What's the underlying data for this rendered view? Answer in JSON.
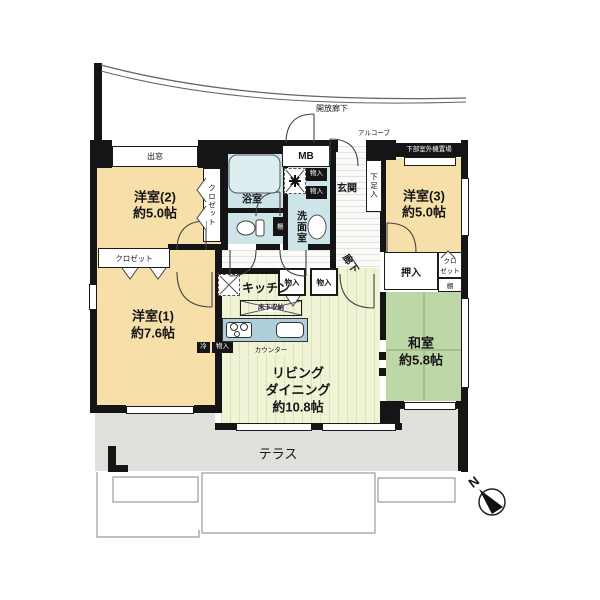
{
  "plan": {
    "compass_n": "N",
    "open_corridor": "開放廊下",
    "alcove": "アルコーブ",
    "outdoor_unit_area": "下部室外機置場",
    "bay_window": "出窓",
    "meter_box": "MB",
    "terrace": "テラス",
    "rooms": {
      "western2_name": "洋室(2)",
      "western2_size": "約5.0帖",
      "western3_name": "洋室(3)",
      "western3_size": "約5.0帖",
      "western1_name": "洋室(1)",
      "western1_size": "約7.6帖",
      "japanese_name": "和室",
      "japanese_size": "約5.8帖",
      "living_line1": "リビング",
      "living_line2": "ダイニング",
      "living_size": "約10.8帖",
      "kitchen": "キッチン",
      "bathroom": "浴室",
      "washroom": "洗面室",
      "entrance": "玄関",
      "hallway": "廊下"
    },
    "storage": {
      "closet_west2": "クロゼット",
      "closet_west1": "クロゼット",
      "closet_east_line1": "クロ",
      "closet_east_line2": "ゼット",
      "closet_east_shelf": "棚",
      "oshiire": "押入",
      "shoe_cabinet": "下足入",
      "storage_a": "物入",
      "storage_b": "物入",
      "storage_c": "物入",
      "storage_d": "物入",
      "underfloor_storage": "床下収納",
      "counter": "カウンター",
      "fridge_badge": "冷",
      "storage_badge": "物入",
      "toilet_shelf": "棚"
    }
  }
}
